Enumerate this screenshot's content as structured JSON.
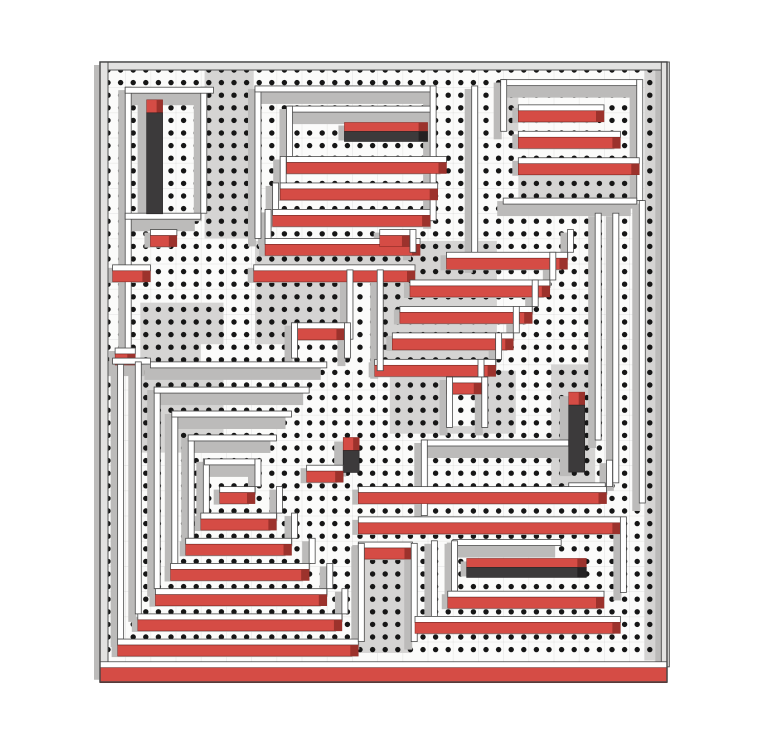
{
  "meta": {
    "kind": "maze-puzzle-render",
    "aria_label": "Top-down 3D maze with dotted corridors, red wall faces and dark pillars",
    "canvas": {
      "width": 768,
      "height": 737
    },
    "maze": {
      "origin_x": 100,
      "origin_y": 62,
      "width": 567,
      "height": 620,
      "unit": 12.6
    }
  },
  "colors": {
    "page_bg": "#ffffff",
    "floor_white": "#fbfbfa",
    "floor_gray": "#d5d4d3",
    "shadow": "#bcbbba",
    "wall_top": "#ffffff",
    "wall_stroke": "#4a4a4a",
    "border_fill": "#e3e2e1",
    "red": "#d54c45",
    "red_dark": "#9c322c",
    "dark": "#3c3a3b",
    "dark_edge": "#242223",
    "dot": "#161616",
    "grid_tint": "#00000010"
  },
  "dots": {
    "spacing": 12.6,
    "radius": 2.7,
    "offset_x": 8,
    "offset_y": 8,
    "cols": 44,
    "rows": 47
  },
  "floors": [
    [
      "gray",
      8.3,
      0.6,
      3.9,
      13.4
    ],
    [
      "gray",
      12.3,
      14.2,
      19.2,
      10.3
    ],
    [
      "gray",
      3.2,
      19.1,
      6.6,
      11.9
    ],
    [
      "gray",
      23.0,
      24.5,
      10.0,
      5.0
    ],
    [
      "gray",
      35.8,
      24.0,
      3.5,
      9.6
    ],
    [
      "gray",
      20.5,
      38.2,
      4.2,
      8.7
    ],
    [
      "gray",
      43.2,
      0.5,
      1.35,
      47.0
    ],
    [
      "gray",
      33.2,
      8.5,
      9.4,
      2.3
    ],
    [
      "gray",
      31.8,
      2.0,
      1.4,
      3.5
    ],
    [
      "white",
      8.0,
      22.4,
      14.0,
      2.2
    ],
    [
      "white",
      19.6,
      16.6,
      2.4,
      8.0
    ],
    [
      "white",
      15.3,
      21.0,
      4.0,
      2.4
    ],
    [
      "white",
      27.7,
      25.3,
      2.4,
      3.6
    ],
    [
      "white",
      8.4,
      31.7,
      3.8,
      3.9
    ]
  ],
  "walls": [
    [
      "bt",
      0,
      0,
      45
    ],
    [
      "bv",
      0,
      0,
      48
    ],
    [
      "bv",
      44.55,
      0,
      48
    ],
    [
      "v",
      2,
      2,
      22
    ],
    [
      "v",
      8,
      2,
      10
    ],
    [
      "p",
      2,
      2,
      7
    ],
    [
      "p",
      2,
      12,
      6
    ],
    [
      "tv",
      3.7,
      3.0,
      114
    ],
    [
      "h",
      4,
      13.3,
      2.1
    ],
    [
      "v",
      12.3,
      1.9,
      12.1
    ],
    [
      "v",
      26.2,
      1.9,
      10.7
    ],
    [
      "v",
      29.5,
      1.9,
      14.2
    ],
    [
      "p",
      12.3,
      1.9,
      13.9
    ],
    [
      "p",
      14.9,
      3.5,
      11.3
    ],
    [
      "th",
      19.4,
      4.8,
      6.6
    ],
    [
      "v",
      14.8,
      3.5,
      4.0
    ],
    [
      "h",
      14.8,
      7.5,
      12.7
    ],
    [
      "v",
      14.3,
      7.5,
      2.1
    ],
    [
      "h",
      14.3,
      9.6,
      12.5
    ],
    [
      "v",
      13.7,
      9.6,
      2.1
    ],
    [
      "h",
      13.7,
      11.7,
      12.5
    ],
    [
      "v",
      13.1,
      11.7,
      2.3
    ],
    [
      "h",
      13.1,
      14.0,
      12.3
    ],
    [
      "h",
      12.2,
      16.1,
      12.8
    ],
    [
      "p",
      31.8,
      1.4,
      10.8
    ],
    [
      "v",
      31.8,
      1.4,
      4.1
    ],
    [
      "v",
      42.6,
      1.4,
      9.6
    ],
    [
      "h",
      33.2,
      3.4,
      6.8
    ],
    [
      "h",
      33.2,
      5.5,
      8.1
    ],
    [
      "h",
      33.2,
      7.6,
      9.6
    ],
    [
      "p",
      32.0,
      10.8,
      10.6
    ],
    [
      "v",
      39.3,
      12,
      18
    ],
    [
      "v",
      40.7,
      12,
      21.4
    ],
    [
      "v",
      42.8,
      11,
      24
    ],
    [
      "h",
      22.2,
      13.3,
      2.4
    ],
    [
      "v",
      24.6,
      13.3,
      1.8
    ],
    [
      "h",
      27.5,
      15.1,
      9.6
    ],
    [
      "v",
      37.1,
      13.3,
      1.8
    ],
    [
      "h",
      24.6,
      17.3,
      11.1
    ],
    [
      "v",
      35.7,
      15.1,
      2.2
    ],
    [
      "h",
      23.8,
      19.4,
      10.5
    ],
    [
      "v",
      34.3,
      17.3,
      2.1
    ],
    [
      "h",
      23.2,
      21.5,
      9.6
    ],
    [
      "v",
      32.8,
      19.4,
      2.1
    ],
    [
      "h",
      21.8,
      23.6,
      9.6
    ],
    [
      "v",
      31.4,
      21.5,
      2.1
    ],
    [
      "v",
      30.0,
      23.6,
      1.4
    ],
    [
      "v",
      22.0,
      16.5,
      8.0
    ],
    [
      "v",
      19.6,
      16.5,
      5.5
    ],
    [
      "h",
      15.2,
      20.7,
      4.2
    ],
    [
      "v",
      15.2,
      20.7,
      2.8
    ],
    [
      "v",
      19.4,
      20.7,
      2.8
    ],
    [
      "h",
      27.5,
      25.0,
      2.8
    ],
    [
      "v",
      27.5,
      25.0,
      4.0
    ],
    [
      "v",
      30.3,
      25.0,
      4.0
    ],
    [
      "tv",
      19.3,
      29.8,
      35
    ],
    [
      "h",
      16.4,
      32.0,
      2.9
    ],
    [
      "h",
      1,
      16.1,
      3
    ],
    [
      "h",
      1.2,
      22.7,
      1.6
    ],
    [
      "p",
      1,
      23.5,
      3
    ],
    [
      "v",
      1.4,
      24.0,
      21.8
    ],
    [
      "v",
      2.8,
      23.8,
      20.0
    ],
    [
      "v",
      4.3,
      25.8,
      16.0
    ],
    [
      "v",
      5.7,
      27.7,
      12.1
    ],
    [
      "v",
      7.0,
      29.6,
      8.2
    ],
    [
      "v",
      8.2,
      31.5,
      4.3
    ],
    [
      "p",
      4.0,
      23.8,
      14.0
    ],
    [
      "p",
      4.3,
      25.8,
      12.3
    ],
    [
      "p",
      5.7,
      27.7,
      9.5
    ],
    [
      "p",
      7.0,
      29.6,
      7.0
    ],
    [
      "p",
      8.3,
      31.5,
      4.0
    ],
    [
      "h",
      9.5,
      33.7,
      2.8
    ],
    [
      "v",
      12.3,
      31.5,
      2.2
    ],
    [
      "h",
      8.0,
      35.8,
      6.0
    ],
    [
      "v",
      14.0,
      33.7,
      2.1
    ],
    [
      "h",
      6.8,
      37.8,
      8.4
    ],
    [
      "v",
      15.2,
      35.8,
      2.0
    ],
    [
      "h",
      5.6,
      39.8,
      11.0
    ],
    [
      "v",
      16.6,
      37.8,
      2.0
    ],
    [
      "h",
      4.4,
      41.8,
      13.6
    ],
    [
      "v",
      18.0,
      39.8,
      2.0
    ],
    [
      "h",
      3.0,
      43.8,
      16.2
    ],
    [
      "v",
      19.2,
      41.8,
      2.0
    ],
    [
      "h",
      1.4,
      45.8,
      19.1
    ],
    [
      "p",
      25.5,
      30.0,
      11.7
    ],
    [
      "v",
      25.5,
      30.0,
      6.0
    ],
    [
      "tv",
      37.2,
      26.2,
      80
    ],
    [
      "h",
      37.2,
      33.4,
      2.9
    ],
    [
      "h",
      20.5,
      33.7,
      19.7
    ],
    [
      "v",
      40.2,
      31.6,
      2.1
    ],
    [
      "h",
      20.5,
      36.1,
      20.8
    ],
    [
      "h",
      20.5,
      38.1,
      4.3
    ],
    [
      "v",
      20.5,
      38.2,
      7.8
    ],
    [
      "v",
      24.7,
      38.2,
      7.8
    ],
    [
      "v",
      26.3,
      38.0,
      6.0
    ],
    [
      "p",
      28.0,
      37.9,
      8.6
    ],
    [
      "th",
      29.1,
      39.4,
      9.5
    ],
    [
      "v",
      27.9,
      38.0,
      4.0
    ],
    [
      "h",
      27.6,
      42.0,
      12.4
    ],
    [
      "h",
      25.0,
      44.0,
      16.3
    ],
    [
      "v",
      41.3,
      36.1,
      6.0
    ],
    [
      "H",
      0,
      47.6,
      45
    ]
  ]
}
